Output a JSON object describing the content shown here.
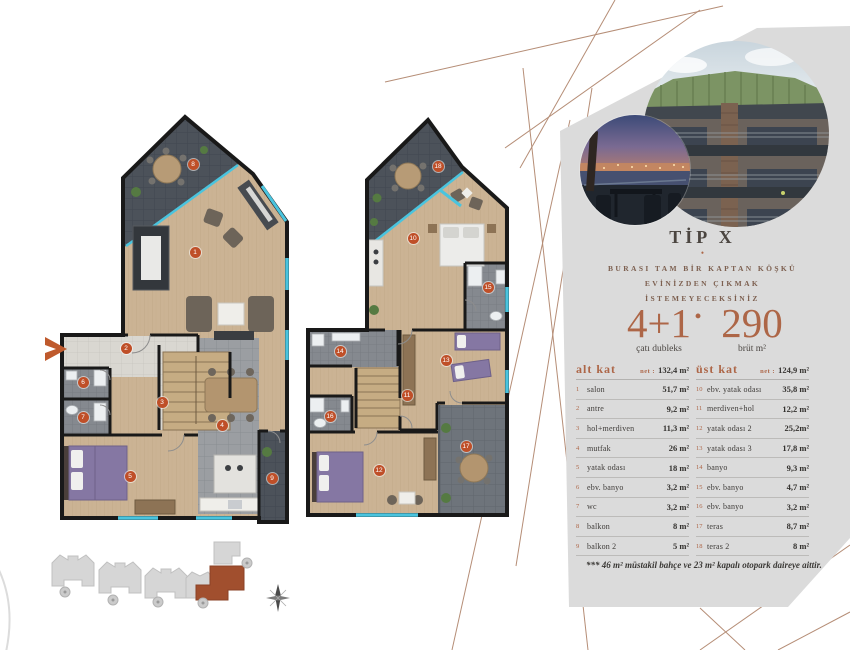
{
  "panel": {
    "title": "TİP X",
    "bullet": "•",
    "tagline_lines": [
      "BURASI TAM BİR KAPTAN KÖŞKÜ",
      "EVİNİZDEN ÇIKMAK",
      "İSTEMEYECEKSİNİZ"
    ],
    "stats": {
      "left_value": "4+1",
      "left_label": "çatı dubleks",
      "separator": "•",
      "right_value": "290",
      "right_label": "brüt m²"
    },
    "table": {
      "left": {
        "header": "alt kat",
        "net_label": "net :",
        "net_value": "132,4 m²",
        "rows": [
          [
            "1",
            "salon",
            "51,7 m²"
          ],
          [
            "2",
            "antre",
            "9,2 m²"
          ],
          [
            "3",
            "hol+merdiven",
            "11,3 m²"
          ],
          [
            "4",
            "mutfak",
            "26 m²"
          ],
          [
            "5",
            "yatak odası",
            "18 m²"
          ],
          [
            "6",
            "ebv. banyo",
            "3,2 m²"
          ],
          [
            "7",
            "wc",
            "3,2 m²"
          ],
          [
            "8",
            "balkon",
            "8 m²"
          ],
          [
            "9",
            "balkon 2",
            "5 m²"
          ]
        ]
      },
      "right": {
        "header": "üst kat",
        "net_label": "net :",
        "net_value": "124,9 m²",
        "rows": [
          [
            "10",
            "ebv. yatak odası",
            "35,8 m²"
          ],
          [
            "11",
            "merdiven+hol",
            "12,2 m²"
          ],
          [
            "12",
            "yatak odası 2",
            "25,2m²"
          ],
          [
            "13",
            "yatak odası 3",
            "17,8 m²"
          ],
          [
            "14",
            "banyo",
            "9,3 m²"
          ],
          [
            "15",
            "ebv. banyo",
            "4,7 m²"
          ],
          [
            "16",
            "ebv. banyo",
            "3,2 m²"
          ],
          [
            "17",
            "teras",
            "8,7 m²"
          ],
          [
            "18",
            "teras 2",
            "8 m²"
          ]
        ]
      }
    },
    "footnote": "*** 46 m² müstakil bahçe ve 23 m² kapalı otopark daireye aittir."
  },
  "floorplans": {
    "lower": {
      "markers": [
        {
          "n": "1",
          "x": 195,
          "y": 252
        },
        {
          "n": "2",
          "x": 126,
          "y": 348
        },
        {
          "n": "3",
          "x": 162,
          "y": 402
        },
        {
          "n": "4",
          "x": 222,
          "y": 425
        },
        {
          "n": "5",
          "x": 130,
          "y": 476
        },
        {
          "n": "6",
          "x": 83,
          "y": 382
        },
        {
          "n": "7",
          "x": 83,
          "y": 417
        },
        {
          "n": "8",
          "x": 193,
          "y": 164
        },
        {
          "n": "9",
          "x": 272,
          "y": 478
        }
      ]
    },
    "upper": {
      "markers": [
        {
          "n": "10",
          "x": 413,
          "y": 238
        },
        {
          "n": "11",
          "x": 407,
          "y": 395
        },
        {
          "n": "12",
          "x": 379,
          "y": 470
        },
        {
          "n": "13",
          "x": 446,
          "y": 360
        },
        {
          "n": "14",
          "x": 340,
          "y": 351
        },
        {
          "n": "15",
          "x": 488,
          "y": 287
        },
        {
          "n": "16",
          "x": 330,
          "y": 416
        },
        {
          "n": "17",
          "x": 466,
          "y": 446
        },
        {
          "n": "18",
          "x": 438,
          "y": 166
        }
      ]
    }
  },
  "colors": {
    "copper_accent": "#ad6647",
    "marker_orange": "#bf4f28",
    "window_cyan": "#4ac4de",
    "panel_gray": "#dbdbdb",
    "highlight_building_brown": "#a14f2e"
  }
}
